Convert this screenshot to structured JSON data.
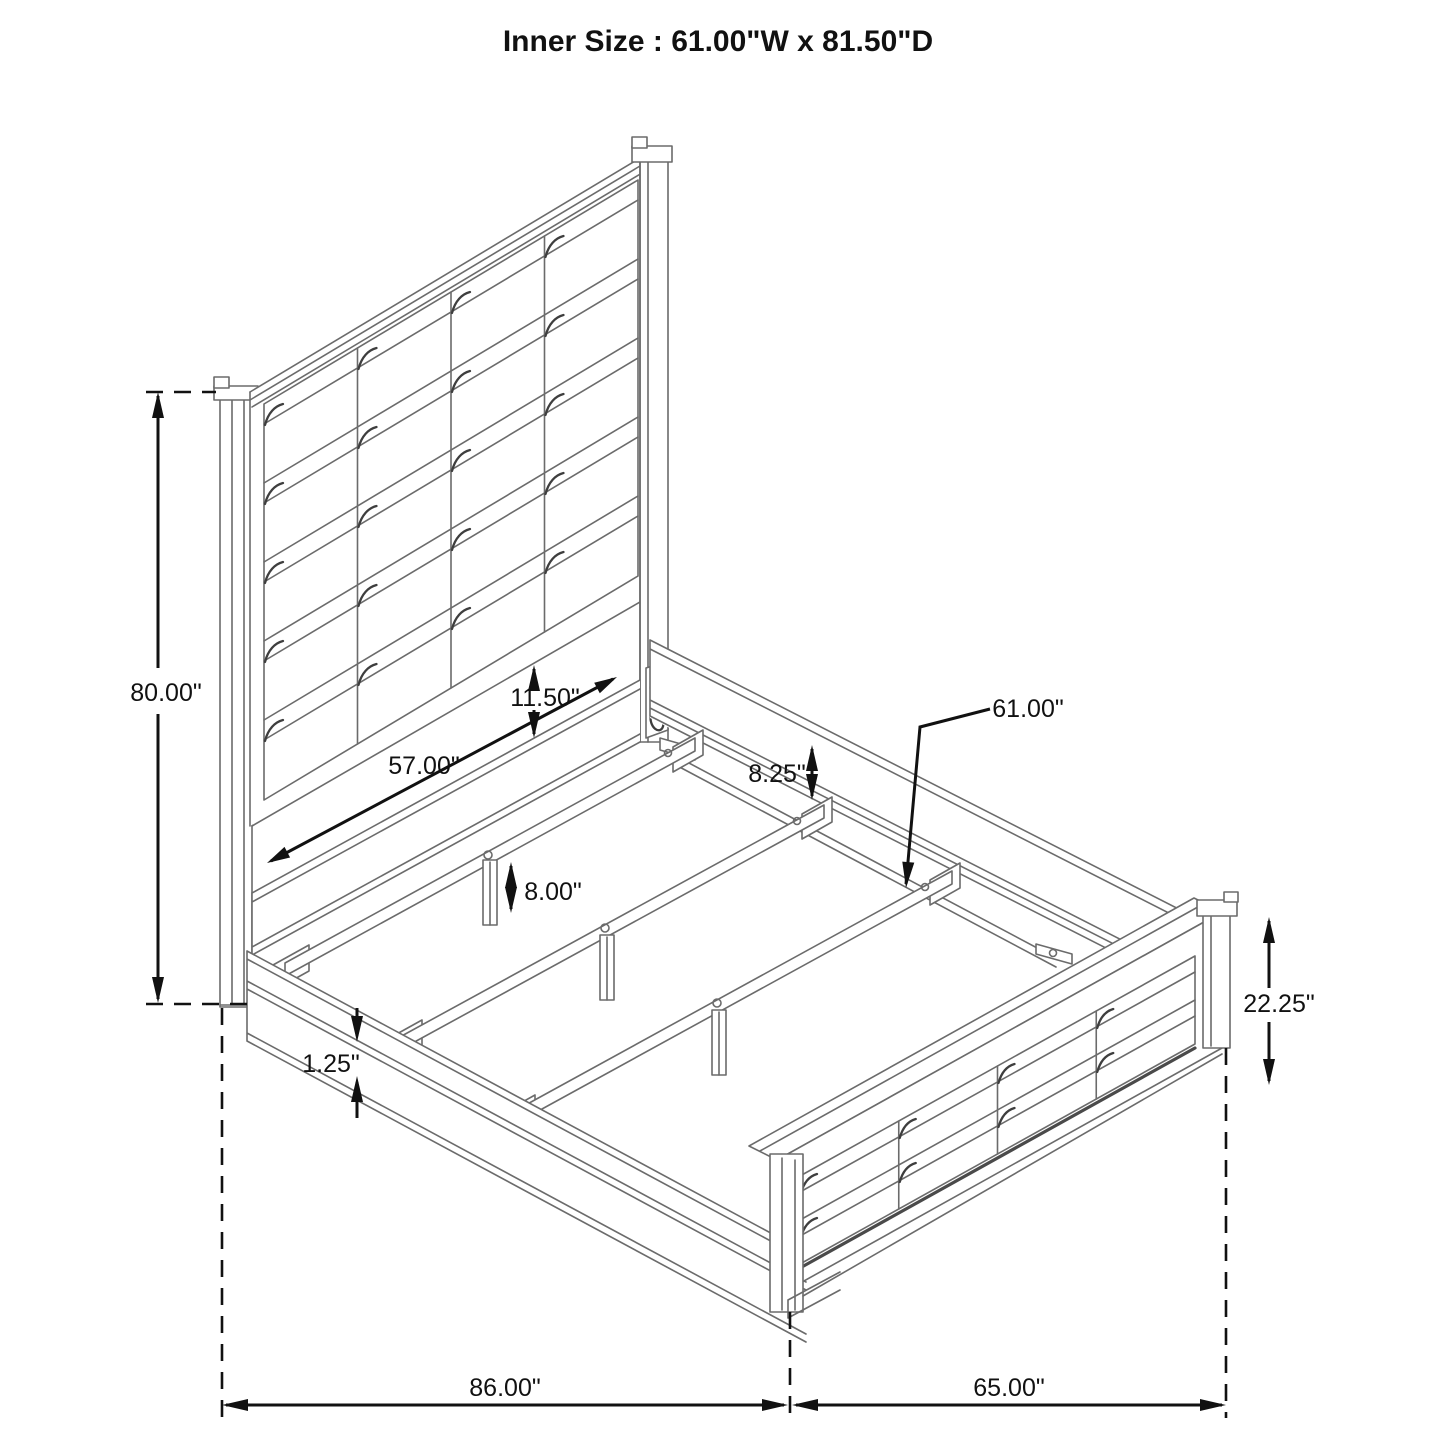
{
  "title": "Inner Size : 61.00\"W x 81.50\"D",
  "diagram": {
    "description": "Isometric line drawing of a panel bed frame with channel-tufted headboard and footboard, side rails, three support slats with legs, and a center rail",
    "line_color": "#6b6b6b",
    "dimension_color": "#111111",
    "background_color": "#ffffff"
  },
  "dimensions": {
    "headboard_height": {
      "label": "80.00\""
    },
    "panel_to_rail_gap": {
      "label": "11.50\""
    },
    "headboard_span": {
      "label": "57.00\""
    },
    "rail_above_slat": {
      "label": "8.25\""
    },
    "slat_length": {
      "label": "61.00\""
    },
    "support_leg_height": {
      "label": "8.00\""
    },
    "rail_lip": {
      "label": "1.25\""
    },
    "footboard_height": {
      "label": "22.25\""
    },
    "overall_length": {
      "label": "86.00\""
    },
    "overall_width": {
      "label": "65.00\""
    }
  }
}
